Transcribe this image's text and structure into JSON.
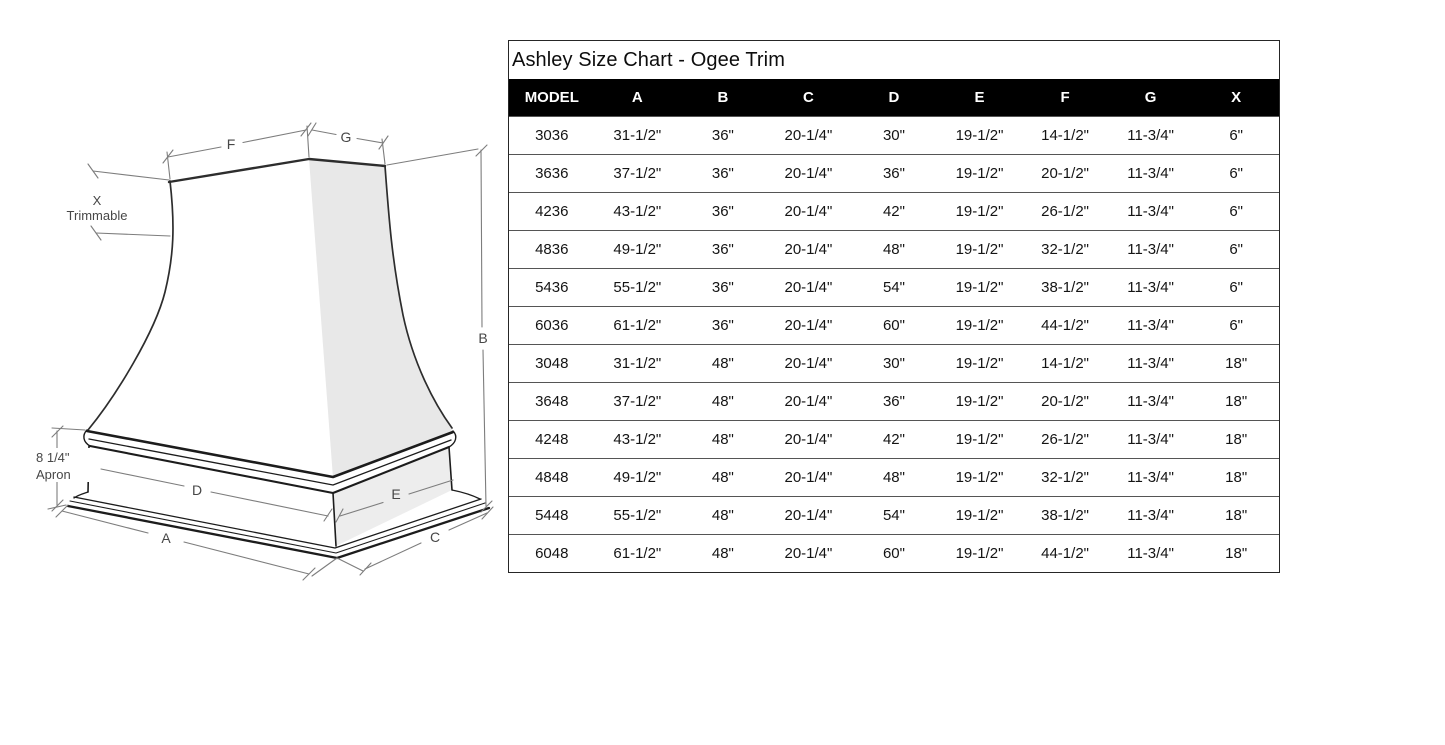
{
  "title": "Ashley Size Chart - Ogee Trim",
  "table": {
    "columns": [
      "MODEL",
      "A",
      "B",
      "C",
      "D",
      "E",
      "F",
      "G",
      "X"
    ],
    "rows": [
      [
        "3036",
        "31-1/2\"",
        "36\"",
        "20-1/4\"",
        "30\"",
        "19-1/2\"",
        "14-1/2\"",
        "11-3/4\"",
        "6\""
      ],
      [
        "3636",
        "37-1/2\"",
        "36\"",
        "20-1/4\"",
        "36\"",
        "19-1/2\"",
        "20-1/2\"",
        "11-3/4\"",
        "6\""
      ],
      [
        "4236",
        "43-1/2\"",
        "36\"",
        "20-1/4\"",
        "42\"",
        "19-1/2\"",
        "26-1/2\"",
        "11-3/4\"",
        "6\""
      ],
      [
        "4836",
        "49-1/2\"",
        "36\"",
        "20-1/4\"",
        "48\"",
        "19-1/2\"",
        "32-1/2\"",
        "11-3/4\"",
        "6\""
      ],
      [
        "5436",
        "55-1/2\"",
        "36\"",
        "20-1/4\"",
        "54\"",
        "19-1/2\"",
        "38-1/2\"",
        "11-3/4\"",
        "6\""
      ],
      [
        "6036",
        "61-1/2\"",
        "36\"",
        "20-1/4\"",
        "60\"",
        "19-1/2\"",
        "44-1/2\"",
        "11-3/4\"",
        "6\""
      ],
      [
        "3048",
        "31-1/2\"",
        "48\"",
        "20-1/4\"",
        "30\"",
        "19-1/2\"",
        "14-1/2\"",
        "11-3/4\"",
        "18\""
      ],
      [
        "3648",
        "37-1/2\"",
        "48\"",
        "20-1/4\"",
        "36\"",
        "19-1/2\"",
        "20-1/2\"",
        "11-3/4\"",
        "18\""
      ],
      [
        "4248",
        "43-1/2\"",
        "48\"",
        "20-1/4\"",
        "42\"",
        "19-1/2\"",
        "26-1/2\"",
        "11-3/4\"",
        "18\""
      ],
      [
        "4848",
        "49-1/2\"",
        "48\"",
        "20-1/4\"",
        "48\"",
        "19-1/2\"",
        "32-1/2\"",
        "11-3/4\"",
        "18\""
      ],
      [
        "5448",
        "55-1/2\"",
        "48\"",
        "20-1/4\"",
        "54\"",
        "19-1/2\"",
        "38-1/2\"",
        "11-3/4\"",
        "18\""
      ],
      [
        "6048",
        "61-1/2\"",
        "48\"",
        "20-1/4\"",
        "60\"",
        "19-1/2\"",
        "44-1/2\"",
        "11-3/4\"",
        "18\""
      ]
    ]
  },
  "diagram": {
    "labels": {
      "f": "F",
      "g": "G",
      "b": "B",
      "d": "D",
      "e": "E",
      "a": "A",
      "c": "C",
      "x": "X",
      "trimmable": "Trimmable",
      "apron_size": "8 1/4\"",
      "apron_word": "Apron"
    }
  },
  "colors": {
    "header_bg": "#000000",
    "header_text": "#ffffff",
    "table_border": "#262626",
    "row_divider": "#555555",
    "shade_face": "#e8e8e8",
    "shade_apron": "#ededed",
    "sketch_line": "#2d2d2d",
    "dim_line": "#7d7d7d"
  }
}
